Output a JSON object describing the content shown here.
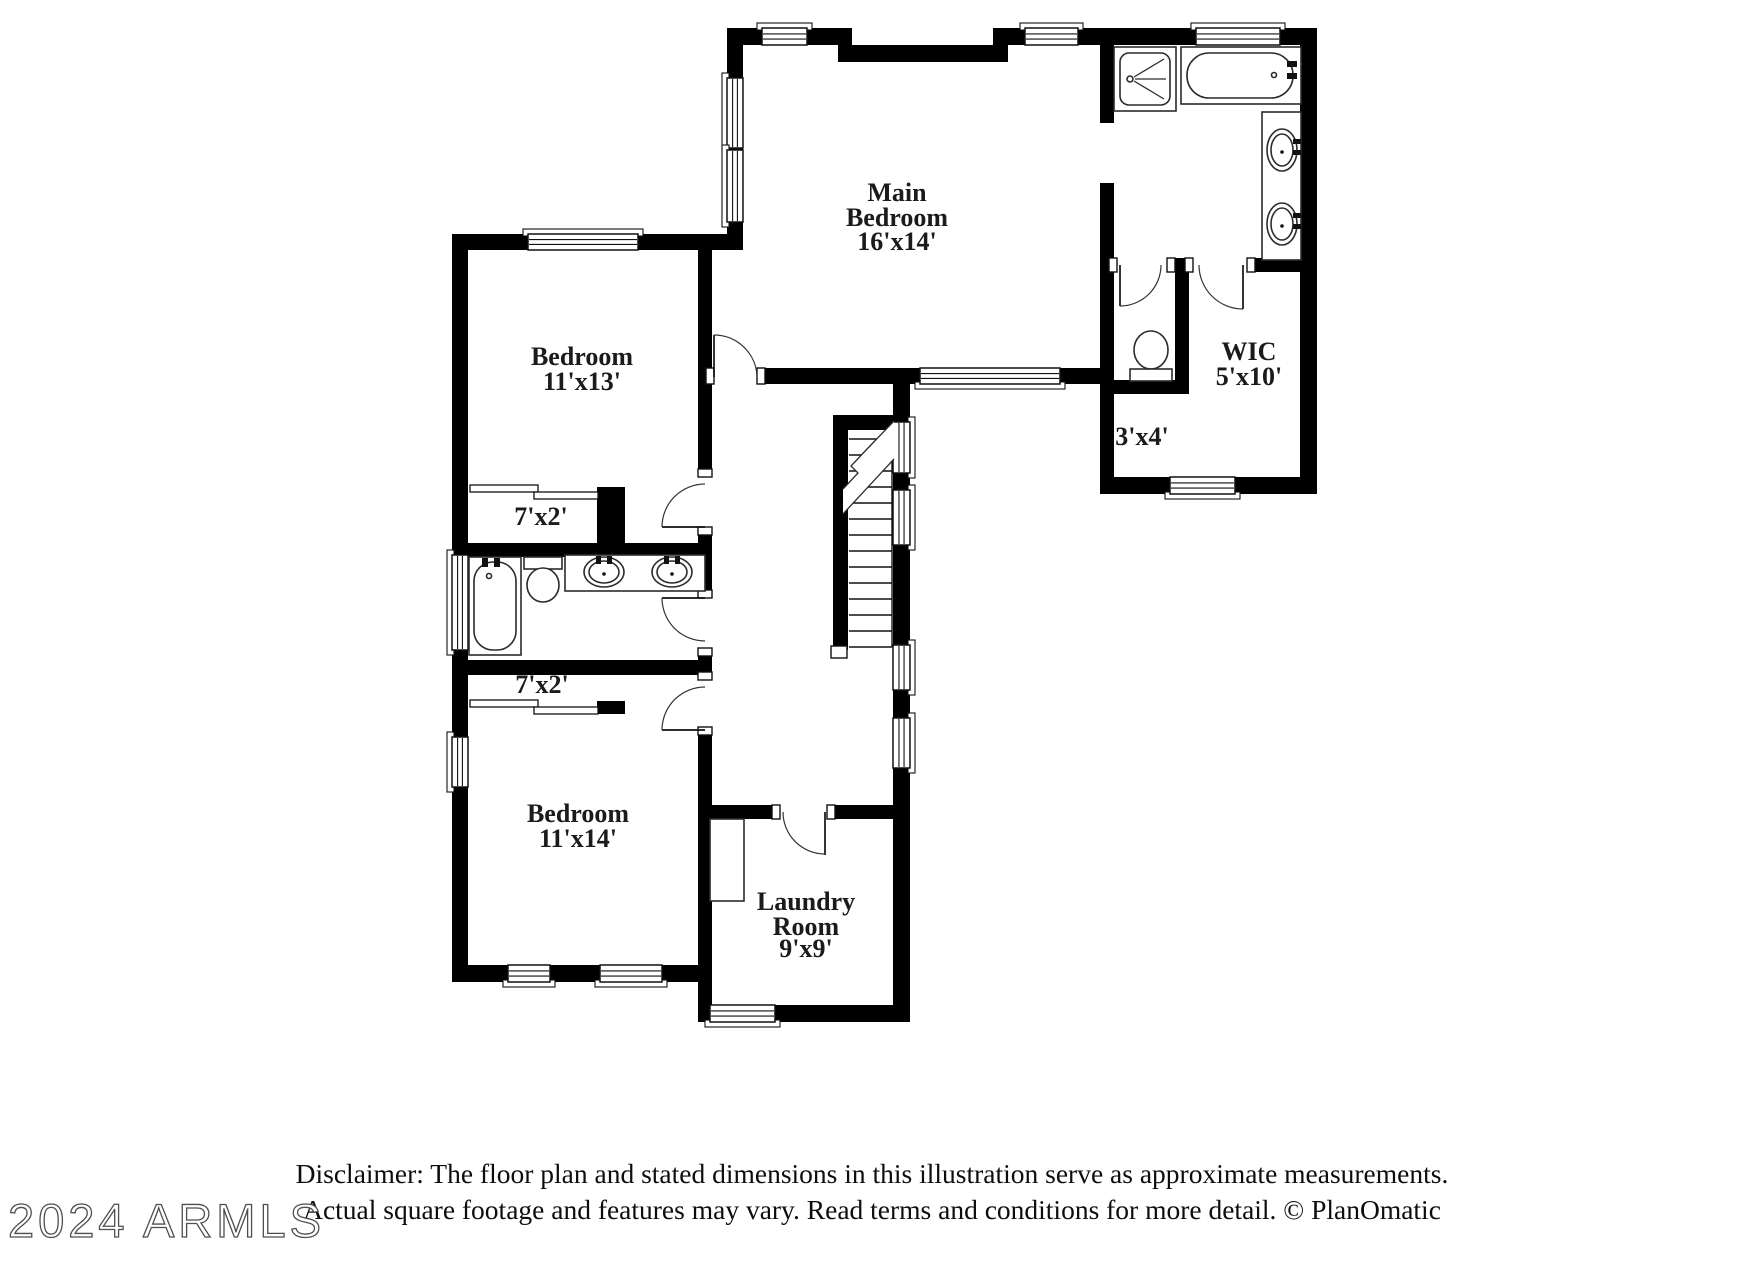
{
  "watermark": {
    "text": "2024 ARMLS"
  },
  "disclaimer": {
    "line1": "Disclaimer: The floor plan and stated dimensions in this illustration serve as approximate measurements.",
    "line2": "Actual square footage and features may vary. Read terms and conditions for more detail. © PlanOmatic"
  },
  "rooms": {
    "main_bedroom": {
      "name": "Main Bedroom",
      "dimensions": "16'x14'",
      "lines": [
        "Main",
        "Bedroom",
        "16'x14'"
      ]
    },
    "bedroom_upper": {
      "name": "Bedroom",
      "dimensions": "11'x13'",
      "lines": [
        "Bedroom",
        "11'x13'"
      ]
    },
    "wic": {
      "name": "WIC",
      "dimensions": "5'x10'",
      "lines": [
        "WIC",
        "5'x10'"
      ]
    },
    "toilet_room": {
      "dimensions": "3'x4'",
      "lines": [
        "3'x4'"
      ]
    },
    "closet_upper": {
      "dimensions": "7'x2'",
      "lines": [
        "7'x2'"
      ]
    },
    "closet_lower": {
      "dimensions": "7'x2'",
      "lines": [
        "7'x2'"
      ]
    },
    "bedroom_lower": {
      "name": "Bedroom",
      "dimensions": "11'x14'",
      "lines": [
        "Bedroom",
        "11'x14'"
      ]
    },
    "laundry": {
      "name": "Laundry Room",
      "dimensions": "9'x9'",
      "lines": [
        "Laundry",
        "Room",
        "9'x9'"
      ]
    }
  },
  "colors": {
    "wall": "#000000",
    "line": "#111111",
    "label": "#1b1b1b",
    "disclaimer_text": "#0d0d0d",
    "watermark_stroke": "#4f4f4f",
    "background": "#ffffff"
  }
}
